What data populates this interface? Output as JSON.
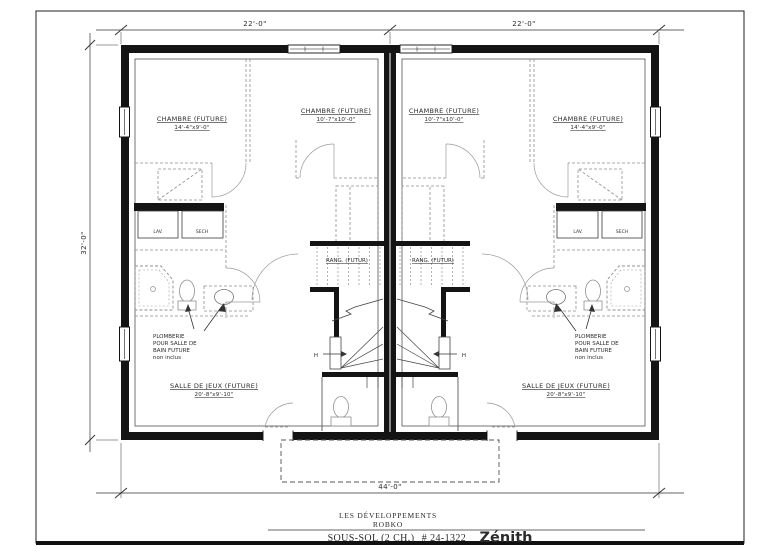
{
  "sheet": {
    "title_block": {
      "developer_line1": "LES DÉVELOPPEMENTS",
      "developer_line2": "ROBKO",
      "plan_name": "SOUS-SOL (2 CH.)",
      "plan_number": "# 24-1322",
      "model": "Zénith"
    },
    "dimensions": {
      "top_left": "22'-0\"",
      "top_right": "22'-0\"",
      "side_left": "32'-0\"",
      "bottom": "44'-0\""
    }
  },
  "unit_left": {
    "bedroom_outer": {
      "label": "CHAMBRE (FUTURE)",
      "size": "14'-4\"x9'-0\""
    },
    "bedroom_inner": {
      "label": "CHAMBRE (FUTURE)",
      "size": "10'-7\"x10'-0\""
    },
    "storage": {
      "label": "RANG. (FUTUR)"
    },
    "playroom": {
      "label": "SALLE DE JEUX (FUTURE)",
      "size": "20'-8\"x9'-10\""
    },
    "washer": "LAV.",
    "dryer": "SECH",
    "plumbing_note": [
      "PLOMBERIE",
      "POUR SALLE DE",
      "BAIN FUTURE",
      "non inclus"
    ],
    "stair_direction": "H"
  },
  "unit_right": {
    "bedroom_outer": {
      "label": "CHAMBRE (FUTURE)",
      "size": "14'-4\"x9'-0\""
    },
    "bedroom_inner": {
      "label": "CHAMBRE (FUTURE)",
      "size": "10'-7\"x10'-0\""
    },
    "storage": {
      "label": "RANG. (FUTUR)"
    },
    "playroom": {
      "label": "SALLE DE JEUX (FUTURE)",
      "size": "20'-8\"x9'-10\""
    },
    "washer": "LAV.",
    "dryer": "SECH",
    "plumbing_note": [
      "PLOMBERIE",
      "POUR SALLE DE",
      "BAIN FUTURE",
      "non inclus"
    ],
    "stair_direction": "H"
  },
  "colors": {
    "wall": "#141414",
    "thin_line": "#3c3c3c",
    "dashed_line": "#8f8f8f",
    "text": "#2b2b2b",
    "background": "#ffffff"
  }
}
